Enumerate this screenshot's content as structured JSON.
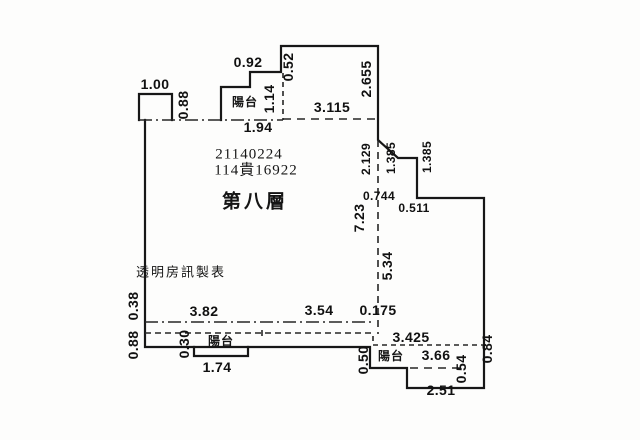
{
  "floor_plan": {
    "serial_number": "21140224",
    "case_number": "114貴16922",
    "floor_label": "第八層",
    "publisher": "透明房訊製表",
    "balconies": {
      "top": "陽台",
      "bottom_left": "陽台",
      "bottom_right": "陽台"
    },
    "dimensions": {
      "top_left_width": "1.00",
      "top_left_height": "0.88",
      "top_step_width": "0.92",
      "top_step_offset": "0.52",
      "top_balcony_depth": "1.14",
      "top_balcony_width": "1.94",
      "top_terrace_width": "3.115",
      "upper_right_height": "2.655",
      "right_upper_height": "2.129",
      "notch_height_left": "1.385",
      "notch_height_right": "1.385",
      "notch_offset": "0.744",
      "notch_width": "0.511",
      "interior_height_total": "7.23",
      "interior_height_lower": "5.34",
      "left_lower_offset": "0.38",
      "left_lower_height": "0.88",
      "bottom_width_left": "3.82",
      "bottom_width_mid": "3.54",
      "bottom_gap": "0.175",
      "bottom_left_balcony_depth": "0.30",
      "bottom_left_balcony_width": "1.74",
      "bottom_step_height": "0.50",
      "bottom_right_terrace_width": "3.425",
      "bottom_right_balcony_width": "3.66",
      "bottom_right_balcony_depth": "0.54",
      "bottom_right_bottom_width": "2.51",
      "right_lower_height": "0.84"
    },
    "colors": {
      "wall_line": "#1c1c1c",
      "dashed_line": "#2a2a2a",
      "background": "#fdfdfc",
      "text": "#161616"
    }
  }
}
